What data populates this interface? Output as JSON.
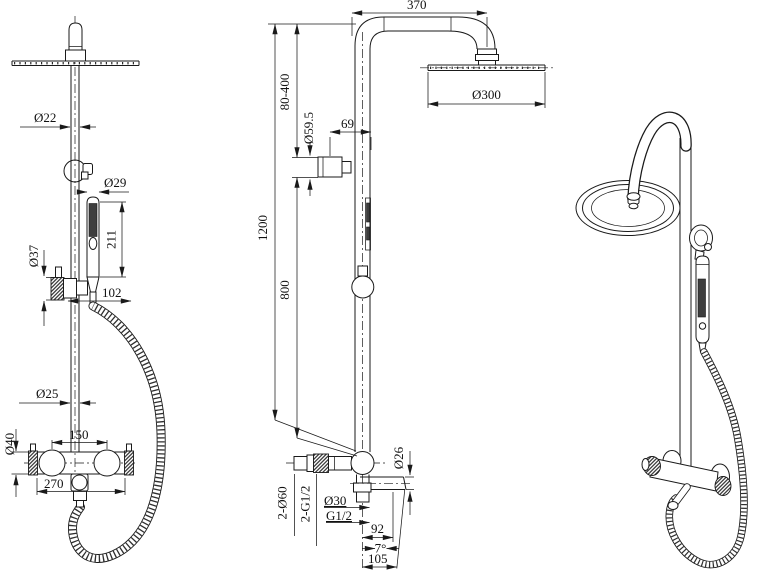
{
  "drawing": {
    "background": "#ffffff",
    "line_color": "#1a1a1a",
    "subject": "shower column technical drawing"
  },
  "views": {
    "front": {
      "name": "front-view",
      "dims": {
        "pipe_d": "Ø22",
        "hand_shower_d": "Ø29",
        "hand_shower_len": "211",
        "slider_d": "Ø37",
        "hand_offset": "102",
        "riser_d": "Ø25",
        "handle_cc": "150",
        "valve_d": "Ø40",
        "valve_w": "270"
      }
    },
    "side": {
      "name": "side-view",
      "dims": {
        "arm_reach": "370",
        "adjust_range": "80-400",
        "head_d": "Ø300",
        "holder_d": "Ø59.5",
        "holder_depth": "69",
        "total_h": "1200",
        "lower_h": "800",
        "escutcheon": "2-Ø60",
        "inlet_thread": "2-G1/2",
        "outlet_d": "Ø30",
        "outlet_thread": "G1/2",
        "spout_reach": "92",
        "spout_angle": "7°",
        "spout_reach_total": "105",
        "spout_d": "Ø26"
      }
    },
    "perspective": {
      "name": "perspective-view"
    }
  }
}
